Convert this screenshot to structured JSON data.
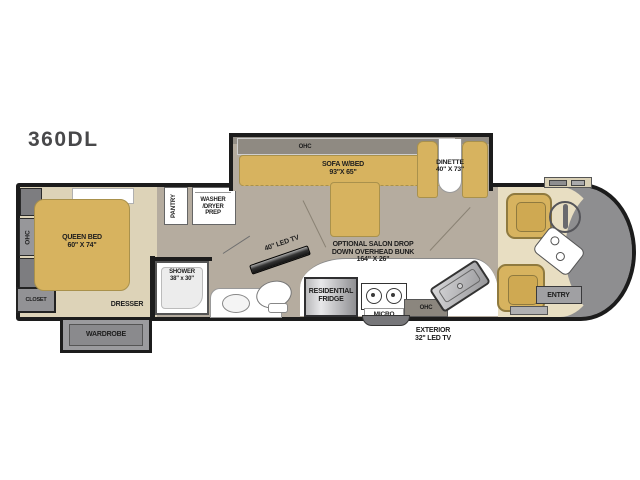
{
  "title": "360DL",
  "bedroom": {
    "ohc": "OHC",
    "closet": "CLOSET",
    "bed": "QUEEN BED\n60\" X 74\"",
    "dresser": "DRESSER",
    "wardrobe": "WARDROBE"
  },
  "utility": {
    "pantry": "PANTRY",
    "washer": "WASHER\n/DRYER\nPREP"
  },
  "bath": {
    "shower": "SHOWER\n38\" x 30\""
  },
  "living": {
    "ohc": "OHC",
    "sofa": "SOFA W/BED\n93\"X 65\"",
    "tv40": "40\" LED TV",
    "bunk": "OPTIONAL SALON DROP\nDOWN OVERHEAD BUNK\n164\" X 26\""
  },
  "dinette": {
    "label": "DINETTE\n40\" X 73\""
  },
  "kitchen": {
    "fridge": "RESIDENTIAL\nFRIDGE",
    "micro": "MICRO",
    "ohc": "OHC",
    "exterior_tv": "EXTERIOR\n32\" LED TV"
  },
  "cab": {
    "entry": "ENTRY"
  },
  "colors": {
    "furniture_tan": "#d7b35f",
    "floor_bedroom": "#ddd3b8",
    "floor_living": "#b5ac9f",
    "floor_cab": "#e8dec2",
    "windshield_grey": "#8e8e90",
    "wall_black": "#1c1c1c"
  }
}
